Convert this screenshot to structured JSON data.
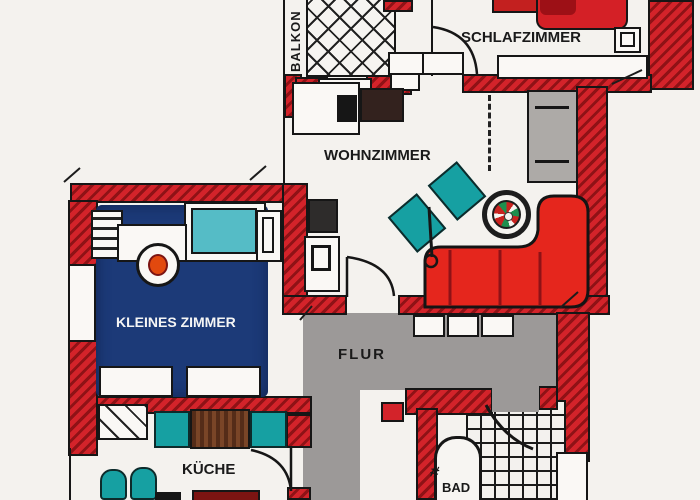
{
  "page": {
    "type": "hand-drawn apartment floor plan"
  },
  "rooms": [
    {
      "id": "balkon",
      "label": "BALKON"
    },
    {
      "id": "schlafzimmer",
      "label": "SCHLAFZIMMER"
    },
    {
      "id": "wohnzimmer",
      "label": "WOHNZIMMER"
    },
    {
      "id": "kleines-zimmer",
      "label": "KLEINES ZIMMER"
    },
    {
      "id": "flur",
      "label": "FLUR"
    },
    {
      "id": "kueche",
      "label": "KÜCHE"
    },
    {
      "id": "bad",
      "label": "BAD"
    }
  ],
  "icons": {
    "faucet": "#"
  },
  "furniture": {
    "schlafzimmer": [
      "double-bed",
      "nightstand",
      "sideboard"
    ],
    "wohnzimmer": [
      "wardrobe",
      "round-table",
      "corner-sofa",
      "armchair",
      "armchair",
      "floor-lamp",
      "tv-board",
      "console",
      "counter"
    ],
    "kleines_zimmer": [
      "radiator",
      "single-bed",
      "nightstand",
      "desk",
      "desk-chair",
      "dresser",
      "dresser"
    ],
    "kueche": [
      "dining-table",
      "kitchen-chair",
      "kitchen-chair",
      "stool",
      "stool",
      "stove"
    ],
    "flur": [
      "built-in-closet"
    ],
    "bad": [
      "bathtub",
      "washing-machine",
      "shower-curtain"
    ]
  },
  "colors": {
    "wall_red": "#d3232a",
    "wall_hatch": "#8f1216",
    "sofa_red": "#e5261d",
    "furniture_teal": "#16a0a2",
    "bed_teal": "#55bcc6",
    "carpet_blue": "#1c3a78",
    "hall_gray": "#9c9998",
    "cabinet_gray": "#adaaa7",
    "table_brown": "#693a21",
    "chair_orange": "#e2490e",
    "ink": "#1a1a1a",
    "paper": "#f4f2ee"
  }
}
